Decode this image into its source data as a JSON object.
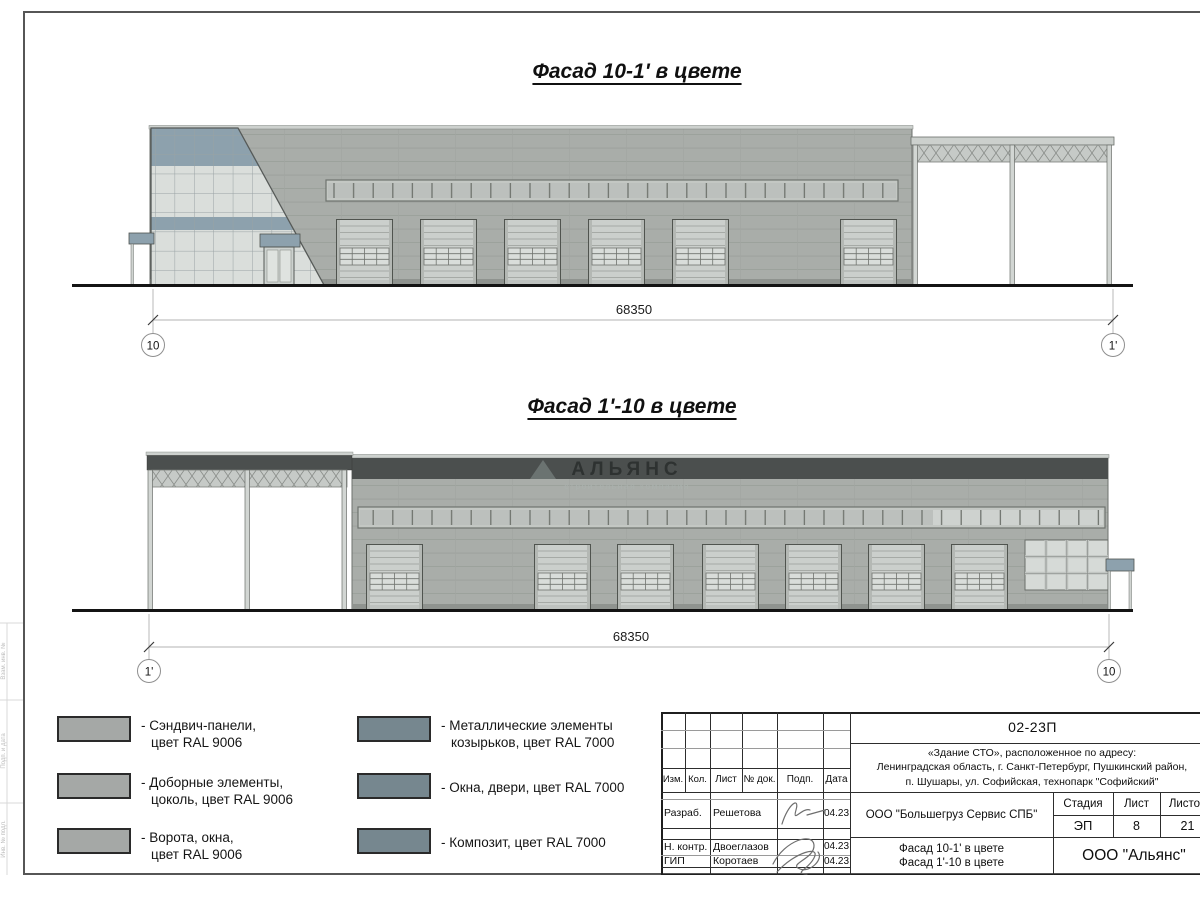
{
  "facade1": {
    "title": "Фасад 10-1' в цвете",
    "dimension": "68350",
    "axis_left": "10",
    "axis_right": "1'"
  },
  "facade2": {
    "title": "Фасад 1'-10 в цвете",
    "dimension": "68350",
    "axis_left": "1'",
    "axis_right": "10",
    "watermark_name": "АЛЬЯНС",
    "watermark_tagline": "строительная компания"
  },
  "legend": {
    "items": [
      {
        "color": "#a5a8a6",
        "line1": "- Сэндвич-панели,",
        "line2": "цвет RAL 9006"
      },
      {
        "color": "#a5a8a6",
        "line1": "- Доборные элементы,",
        "line2": "цоколь, цвет RAL 9006"
      },
      {
        "color": "#a5a8a6",
        "line1": "- Ворота, окна,",
        "line2": "цвет RAL 9006"
      },
      {
        "color": "#76878f",
        "line1": "- Металлические элементы",
        "line2": "козырьков, цвет RAL 7000"
      },
      {
        "color": "#76878f",
        "line1": "- Окна, двери, цвет RAL 7000",
        "line2": ""
      },
      {
        "color": "#76878f",
        "line1": "- Композит, цвет RAL 7000",
        "line2": ""
      }
    ]
  },
  "stamp": {
    "doc_number": "02-23П",
    "address_line1": "«Здание СТО», расположенное по адресу:",
    "address_line2": "Ленинградская область, г. Санкт-Петербург, Пушкинский район,",
    "address_line3": "п. Шушары, ул. Софийская, технопарк \"Софийский\"",
    "col_izm": "Изм.",
    "col_kol": "Кол.",
    "col_list": "Лист",
    "col_doc": "№ док.",
    "col_podp": "Подп.",
    "col_data": "Дата",
    "rows": [
      {
        "role": "Разраб.",
        "name": "Решетова",
        "date": "04.23"
      },
      {
        "role": "Н. контр.",
        "name": "Двоеглазов",
        "date": "04.23"
      },
      {
        "role": "ГИП",
        "name": "Коротаев",
        "date": "04.23"
      }
    ],
    "org": "ООО \"Большегруз Сервис СПБ\"",
    "stage_label": "Стадия",
    "sheet_label": "Лист",
    "sheets_label": "Листов",
    "stage": "ЭП",
    "sheet": "8",
    "sheets": "21",
    "title_line1": "Фасад 10-1' в цвете",
    "title_line2": "Фасад 1'-10 в цвете",
    "company": "ООО \"Альянс\""
  },
  "margin": {
    "label1": "Взам. инв. №",
    "label2": "Подп. и дата",
    "label3": "Инв. № подл."
  }
}
